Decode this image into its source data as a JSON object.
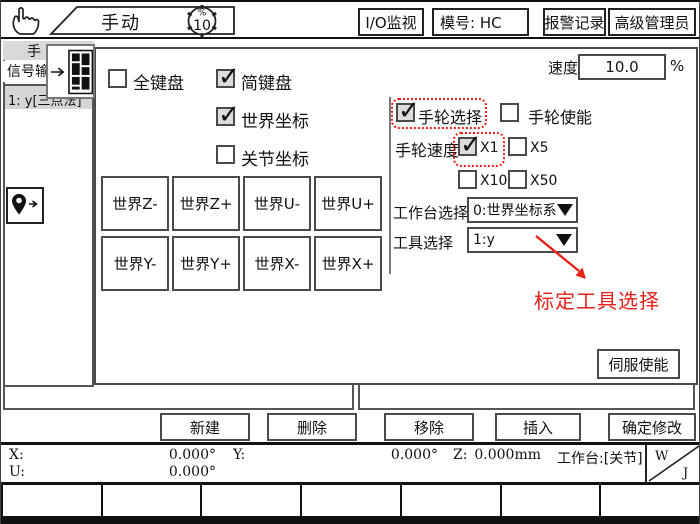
{
  "topbar": {
    "mode_label": "手动",
    "speed_value": "10",
    "speed_unit": "%",
    "buttons": [
      {
        "label": "I/O监视"
      },
      {
        "label": "模号: HC"
      },
      {
        "label": "报警记录"
      },
      {
        "label": "高级管理员"
      }
    ]
  },
  "sidebar": {
    "tab_top": "手",
    "tab_bottom": "信号输",
    "list_item": "1: y[三点法]"
  },
  "dialog": {
    "speed": {
      "label": "速度",
      "value": "10.0",
      "unit": "%"
    },
    "keyboard_checkboxes": [
      {
        "label": "全键盘",
        "checked": false
      },
      {
        "label": "简键盘",
        "checked": true
      }
    ],
    "coord_checkboxes": [
      {
        "label": "世界坐标",
        "checked": true
      },
      {
        "label": "关节坐标",
        "checked": false
      }
    ],
    "jog_buttons": [
      "世界Z-",
      "世界Z+",
      "世界U-",
      "世界U+",
      "世界Y-",
      "世界Y+",
      "世界X-",
      "世界X+"
    ],
    "handwheel": {
      "select_label": "手轮选择",
      "select_checked": true,
      "enable_label": "手轮使能",
      "enable_checked": false,
      "speed_label": "手轮速度",
      "speed_options": [
        {
          "label": "X1",
          "checked": true
        },
        {
          "label": "X5",
          "checked": false
        },
        {
          "label": "X10",
          "checked": false
        },
        {
          "label": "X50",
          "checked": false
        }
      ]
    },
    "worktable_select": {
      "label": "工作台选择",
      "value": "0:世界坐标系"
    },
    "tool_select": {
      "label": "工具选择",
      "value": "1:y"
    },
    "annotation": "标定工具选择",
    "servo_button": "伺服使能"
  },
  "bottom_buttons": [
    "新建",
    "删除",
    "移除",
    "插入",
    "确定修改"
  ],
  "status_bar": {
    "x_label": "X:",
    "x_value": "0.000°",
    "y_label": "Y:",
    "y_value": "0.000°",
    "z_label": "Z:",
    "z_value": "0.000mm",
    "u_label": "U:",
    "u_value": "0.000°",
    "worktable": "工作台:[关节]",
    "w_label": "W",
    "j_label": "J"
  },
  "icons": {
    "hand": "pointer-hand",
    "gear": "speed-gear",
    "popup_arrow": "right-arrow",
    "keypad": "keypad-grid",
    "pin": "location-pin",
    "dropdown": "down-triangle"
  },
  "colors": {
    "annotation_red": "#e8201a",
    "border_dark": "#4a4a4a",
    "checked_bg": "#dcdcdc"
  }
}
